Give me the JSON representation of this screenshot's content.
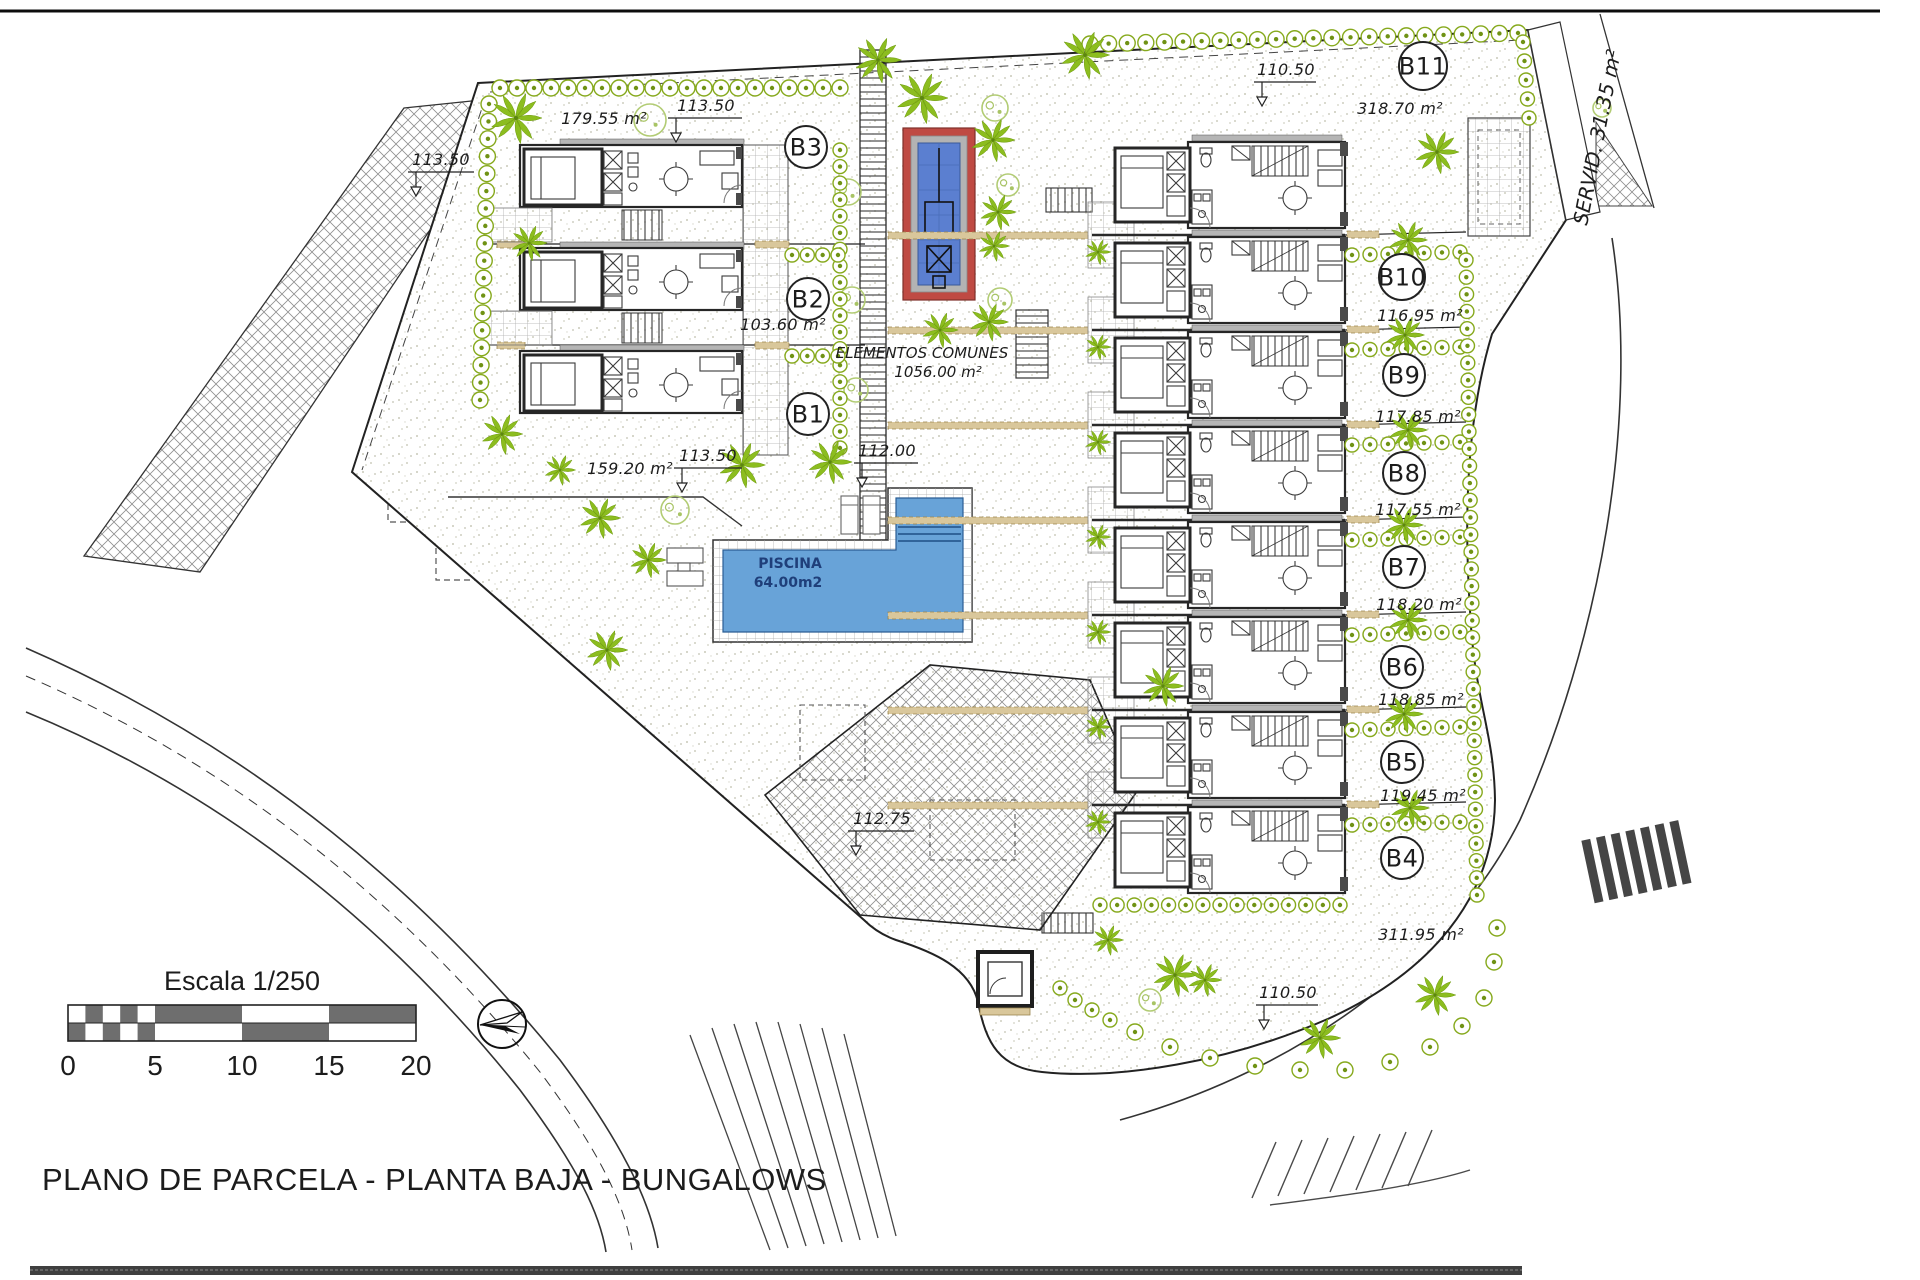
{
  "page": {
    "title": "PLANO DE PARCELA - PLANTA BAJA - BUNGALOWS"
  },
  "scale_bar": {
    "title": "Escala 1/250",
    "ticks": [
      "0",
      "5",
      "10",
      "15",
      "20"
    ]
  },
  "common_area": {
    "line1": "ELEMENTOS COMUNES",
    "line2": "1056.00 m²"
  },
  "pool": {
    "name": "PISCINA",
    "area": "64.00m2"
  },
  "servitude_label": "SERVID. 31.35 m²",
  "units": [
    {
      "id": "B1",
      "area": "159.20 m²"
    },
    {
      "id": "B2",
      "area": "103.60 m²"
    },
    {
      "id": "B3",
      "area": "179.55 m²"
    },
    {
      "id": "B4",
      "area": "311.95 m²"
    },
    {
      "id": "B5",
      "area": "119.45 m²"
    },
    {
      "id": "B6",
      "area": "118.85 m²"
    },
    {
      "id": "B7",
      "area": "118.20 m²"
    },
    {
      "id": "B8",
      "area": "117.55 m²"
    },
    {
      "id": "B9",
      "area": "117.85 m²"
    },
    {
      "id": "B10",
      "area": "116.95 m²"
    },
    {
      "id": "B11",
      "area": "318.70 m²"
    }
  ],
  "dimensions": [
    "113.50",
    "113.50",
    "113.50",
    "112.00",
    "112.75",
    "110.50",
    "110.50"
  ]
}
